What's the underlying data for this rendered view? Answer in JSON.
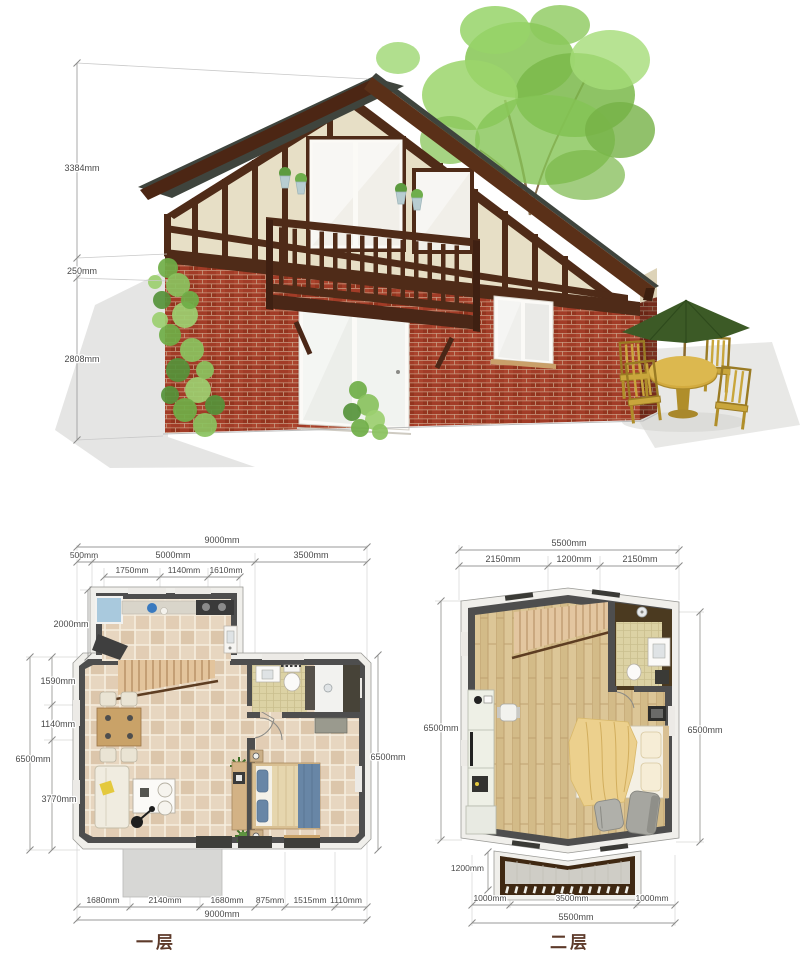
{
  "palette": {
    "brick": "#a23c27",
    "brick_shade": "#7e2c1a",
    "roof": "#3f443d",
    "timber": "#4f2b18",
    "stucco": "#e7dfc6",
    "umbrella_green": "#3c5a26",
    "patio_wood": "#c9a63c",
    "plan_wall_dark": "#4e4e4e",
    "plan_wall_light": "#f0efeb",
    "tile_floor": "#e7d6c0",
    "wood_floor": "#dcc697",
    "bed_blue": "#6886a6",
    "blanket_yellow": "#ecd08d",
    "dim_text": "#4a4a4a",
    "label_brown": "#5d3a2a"
  },
  "elevation": {
    "dims": [
      "3384mm",
      "250mm",
      "2808mm"
    ]
  },
  "plans": {
    "first": {
      "label": "一层",
      "top": [
        "9000mm",
        "500mm",
        "5000mm",
        "3500mm",
        "1750mm",
        "1140mm",
        "1610mm"
      ],
      "left": [
        "2000mm",
        "1590mm",
        "1140mm",
        "3770mm",
        "6500mm"
      ],
      "right": [
        "6500mm"
      ],
      "bottom": [
        "1680mm",
        "2140mm",
        "1680mm",
        "875mm",
        "1515mm",
        "1110mm",
        "9000mm"
      ]
    },
    "second": {
      "label": "二层",
      "top": [
        "5500mm",
        "2150mm",
        "1200mm",
        "2150mm"
      ],
      "left": [
        "6500mm",
        "1200mm"
      ],
      "right": [
        "6500mm"
      ],
      "bottom": [
        "1000mm",
        "3500mm",
        "1000mm",
        "5500mm"
      ]
    }
  }
}
